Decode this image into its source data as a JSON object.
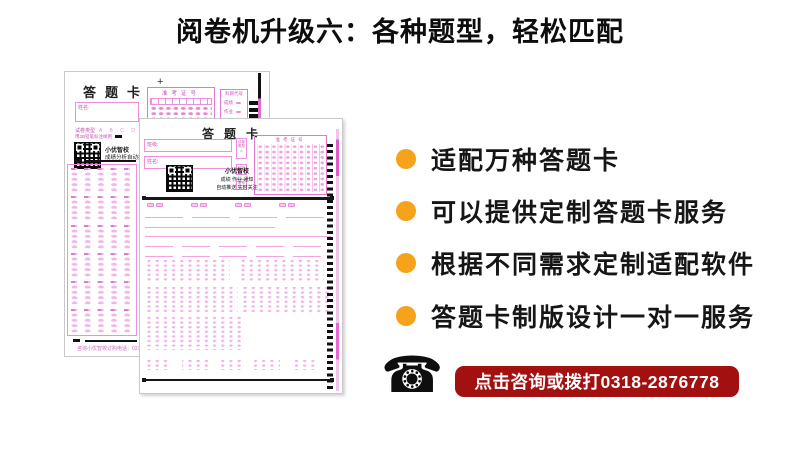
{
  "title": "阅卷机升级六：各种题型，轻松匹配",
  "features": {
    "bullet_color": "#F6A21B",
    "items": [
      {
        "label": "适配万种答题卡"
      },
      {
        "label": "可以提供定制答题卡服务"
      },
      {
        "label": "根据不同需求定制适配软件"
      },
      {
        "label": "答题卡制版设计一对一服务"
      }
    ]
  },
  "contact": {
    "phone_icon": "☎",
    "banner_label": "点击咨询或拨打0318-2876778",
    "banner_color": "#A31010"
  },
  "sheet_back": {
    "title": "答题卡",
    "name_label": "姓名:",
    "paper_type_label": "试卷类型",
    "paper_type_options": "A B C D",
    "pencil_note": "用2B铅笔标注样例",
    "qr_caption_line1": "小优智校",
    "qr_caption_line2": "成绩分析自动推送",
    "plus_mark": "+",
    "exam_no_label": "准考证号",
    "subject_code_label": "科目代号",
    "subject_row1": "成绩",
    "subject_row2": "作业",
    "footer_note": "咨询小优智校订购电话：0318-287"
  },
  "sheet_front": {
    "title": "答题卡",
    "class_label": "班级:",
    "name_label": "姓名:",
    "paper_type_label": "试卷类型",
    "paper_type_option": "A",
    "barcode_label": "贴码",
    "exam_small_label": "考号",
    "exam_no_label": "准考证号",
    "qr_caption_line1": "小优智校",
    "qr_caption_line2": "成绩 作业 通知",
    "qr_caption_line3": "自动推送 实时关注"
  },
  "sheet_colors": {
    "sheet_pink": "#EF8EDB",
    "bubble_fill": "#F3B6E9",
    "label_pink": "#CC4FB8"
  }
}
